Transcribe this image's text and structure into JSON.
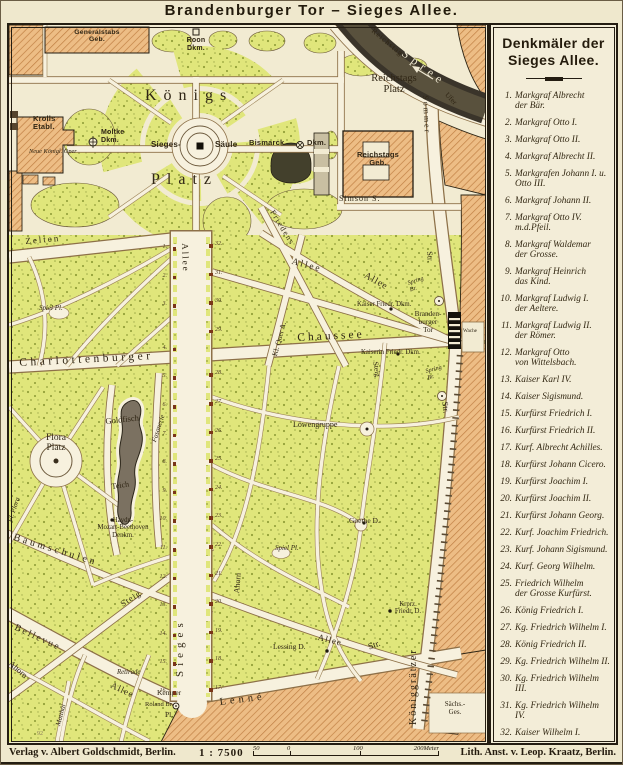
{
  "title": "Brandenburger Tor – Sieges Allee.",
  "colors": {
    "paper": "#f2ebd2",
    "park_green": "#e0e67b",
    "building_orange": "#edbd85",
    "water_dark": "#3a342a",
    "monument_brown": "#7a3519",
    "ink": "#241d12"
  },
  "legend": {
    "heading": "Denkmäler der\nSieges Allee.",
    "entries": [
      {
        "n": "1.",
        "t": "Markgraf Albrecht\nder Bär."
      },
      {
        "n": "2.",
        "t": "Markgraf Otto I."
      },
      {
        "n": "3.",
        "t": "Markgraf Otto II."
      },
      {
        "n": "4.",
        "t": "Markgraf Albrecht II."
      },
      {
        "n": "5.",
        "t": "Markgrafen Johann I. u.\nOtto III."
      },
      {
        "n": "6.",
        "t": "Markgraf Johann II."
      },
      {
        "n": "7.",
        "t": "Markgraf Otto IV.\nm.d.Pfeil."
      },
      {
        "n": "8.",
        "t": "Markgraf Waldemar\nder Grosse."
      },
      {
        "n": "9.",
        "t": "Markgraf Heinrich\ndas Kind."
      },
      {
        "n": "10.",
        "t": "Markgraf Ludwig I.\nder Aeltere."
      },
      {
        "n": "11.",
        "t": "Markgraf Ludwig II.\nder Römer."
      },
      {
        "n": "12.",
        "t": "Markgraf Otto\nvon Wittelsbach."
      },
      {
        "n": "13.",
        "t": "Kaiser Karl IV."
      },
      {
        "n": "14.",
        "t": "Kaiser Sigismund."
      },
      {
        "n": "15.",
        "t": "Kurfürst Friedrich I."
      },
      {
        "n": "16.",
        "t": "Kurfürst Friedrich II."
      },
      {
        "n": "17.",
        "t": "Kurf. Albrecht Achilles."
      },
      {
        "n": "18.",
        "t": "Kurfürst Johann Cicero."
      },
      {
        "n": "19.",
        "t": "Kurfürst Joachim I."
      },
      {
        "n": "20.",
        "t": "Kurfürst Joachim II."
      },
      {
        "n": "21.",
        "t": "Kurfürst Johann Georg."
      },
      {
        "n": "22.",
        "t": "Kurf. Joachim Friedrich."
      },
      {
        "n": "23.",
        "t": "Kurf. Johann Sigismund."
      },
      {
        "n": "24.",
        "t": "Kurf. Georg Wilhelm."
      },
      {
        "n": "25.",
        "t": "Friedrich Wilhelm\nder Grosse Kurfürst."
      },
      {
        "n": "26.",
        "t": "König Friedrich I."
      },
      {
        "n": "27.",
        "t": "Kg. Friedrich Wilhelm I."
      },
      {
        "n": "28.",
        "t": "König Friedrich II."
      },
      {
        "n": "29.",
        "t": "Kg. Friedrich Wilhelm II."
      },
      {
        "n": "30.",
        "t": "Kg. Friedrich Wilhelm III."
      },
      {
        "n": "31.",
        "t": "Kg. Friedrich Wilhelm IV."
      },
      {
        "n": "32.",
        "t": "Kaiser Wilhelm I."
      }
    ]
  },
  "map": {
    "labels": {
      "generalstab": "Generalstabs\nGeb.",
      "roon": "Roon\nDkm.",
      "koenigs": "Königs",
      "platz": "Platz",
      "krolls": "Krolls\nEtabl.",
      "neue_oper": "Neue Königl. Oper",
      "moltke": "Moltke\nDkm.",
      "sieges_saeule_1": "Sieges-",
      "sieges_saeule_2": "Säule",
      "bismarck_1": "Bismarck",
      "bismarck_2": "Dkm.",
      "reichstags_platz": "Reichstags\nPlatz",
      "reichstags_geb": "Reichstags\nGeb.",
      "reichstags_ufer_1": "Reichstags",
      "reichstags_ufer_2": "Ufer",
      "spree": "Spree",
      "sommer": "Sommer",
      "sommer_str": "Str.",
      "simson": "Simson S.",
      "friedens": "Friedens",
      "zelten": "Zelten",
      "allee_upper": "Allee",
      "allee_diag1": "Allee",
      "allee_diag2": "Allee",
      "kl_quer": "Kl. Quer A.",
      "spielplatz_nw": "Spiel Pl.",
      "charlottenburger": "Charlottenburger",
      "chaussee": "Chaussee",
      "kaiser_friedrich": "Kaiser Friedr. Dkm.",
      "kaiserin_friedrich": "Kaiserin Friedr. Dkm.",
      "brandenburger_tor": "Branden-\nburger\nTor",
      "spring_br_1": "Spring\nBr.",
      "spring_br_2": "Spring\nBr.",
      "wache": "Wache",
      "steig_tor": "Steig",
      "flora_platz": "Flora\nPlatz",
      "goldfisch": "Goldfisch",
      "teich": "Teich",
      "fasanerie": "Fasanerie",
      "haydn_denkmal": "Haydn-\nMozart-Beethoven\nDenkm.",
      "baumschulen": "Baumschulen",
      "fl_flora": "Fl. Flora",
      "loewengruppe": "Löwengruppe",
      "goethe": "Goethe D.",
      "ahorn_mitte": "Ahorn",
      "spielplatz_sued": "Spiel Pl.",
      "str_koeniggraetzer_oben": "Str.",
      "kronprinz_friedrich": "Krprz.\nFriedr. D.",
      "lessing": "Lessing D.",
      "allee_se": "Allee",
      "sieges": "Sieges",
      "steig_sw": "Steig",
      "bellevue": "Bellevue",
      "allee_sw": "Allee",
      "ahorn_sw": "Ahorn",
      "matthaei": "Matthäi",
      "retirade": "Retirade",
      "kemper": "Kemper",
      "roland_br": "Roland Br.",
      "kemper_pl": "Pl.",
      "lenne": "Lenné",
      "koeniggraetzer": "Königgrätzer",
      "str_diag": "Str.",
      "saechsische_gesandtschaft": "Sächs.-\nGes.",
      "plate_number": "92"
    },
    "monument_numbers": {
      "west": [
        "1.",
        "2.",
        "3.",
        "4.",
        "5.",
        "6.",
        "7.",
        "8.",
        "9.",
        "10.",
        "11.",
        "12.",
        "13.",
        "14.",
        "15.",
        "16."
      ],
      "east": [
        "32.",
        "31.",
        "30.",
        "29.",
        "28.",
        "27.",
        "26.",
        "25.",
        "24.",
        "23.",
        "22.",
        "21.",
        "20.",
        "19.",
        "18.",
        "17."
      ]
    }
  },
  "footer": {
    "publisher": "Verlag v. Albert Goldschmidt, Berlin.",
    "scale": "1 : 7500",
    "ticks": [
      "50",
      "0",
      "100",
      "200Meter"
    ],
    "lith": "Lith. Anst. v. Leop. Kraatz, Berlin."
  }
}
